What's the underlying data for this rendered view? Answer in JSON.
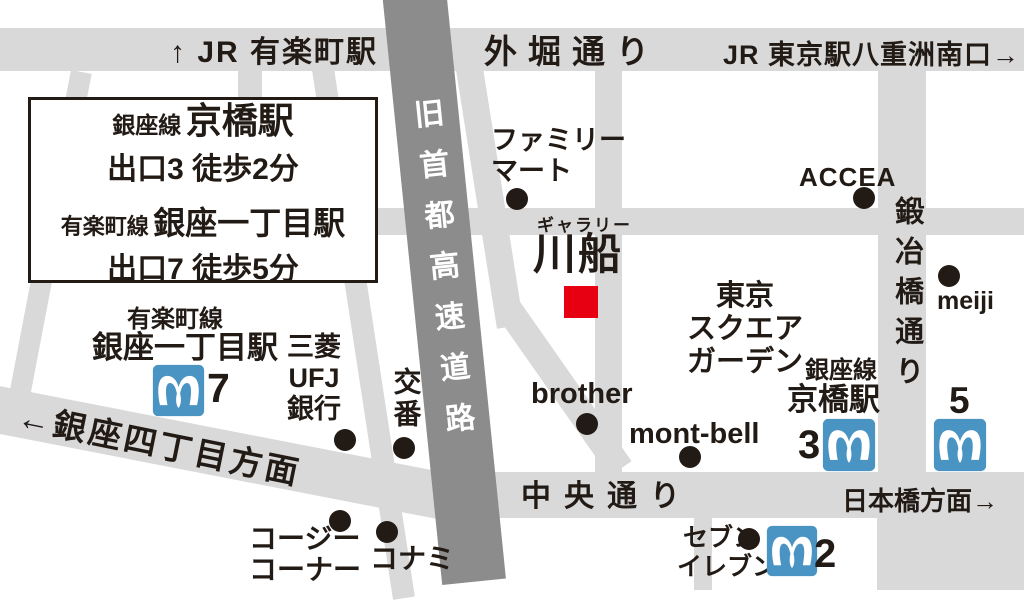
{
  "title": "ギャラリー川船 アクセスマップ",
  "colors": {
    "road": "#d9d9d9",
    "expressway": "#8c8c8c",
    "metro_blue": "#4a94c4",
    "marker_red": "#e60012",
    "ink": "#221a15",
    "bg": "#ffffff"
  },
  "directions": {
    "jr_yurakucho": "↑ JR 有楽町駅",
    "jr_tokyo_yaesu": "JR 東京駅八重洲南口→",
    "ginza4_chome": "←銀座四丁目方面",
    "nihonbashi": "日本橋方面→"
  },
  "streets": {
    "sotobori_dori": "外堀通り",
    "chuo_dori": "中央通り",
    "kajibashi_dori": "鍛冶橋通り",
    "old_expressway": "旧首都高速道路"
  },
  "info_box": {
    "line1_small": "銀座線",
    "line1_large": "京橋駅",
    "line2": "出口3 徒歩2分",
    "line3_small": "有楽町線",
    "line3_large": "銀座一丁目駅",
    "line4": "出口7 徒歩5分"
  },
  "gallery": {
    "type_label": "ギャラリー",
    "name": "川船"
  },
  "stations": {
    "kyobashi_line": "銀座線",
    "kyobashi_name": "京橋駅",
    "kyobashi_exit": "3",
    "ginza1_line": "有楽町線",
    "ginza1_name": "銀座一丁目駅",
    "ginza1_exit": "7",
    "exit5": "5",
    "exit2": "2"
  },
  "places": {
    "familymart_l1": "ファミリー",
    "familymart_l2": "マート",
    "accea": "ACCEA",
    "meiji": "meiji",
    "tokyo_square_garden_l1": "東京",
    "tokyo_square_garden_l2": "スクエア",
    "tokyo_square_garden_l3": "ガーデン",
    "montbell": "mont-bell",
    "brother": "brother",
    "seven_l1": "セブン",
    "seven_l2": "イレブン",
    "mitsubishi_l1": "三菱",
    "mitsubishi_l2": "UFJ",
    "mitsubishi_l3": "銀行",
    "koban": "交番",
    "cozy_l1": "コージー",
    "cozy_l2": "コーナー",
    "konami": "コナミ"
  }
}
